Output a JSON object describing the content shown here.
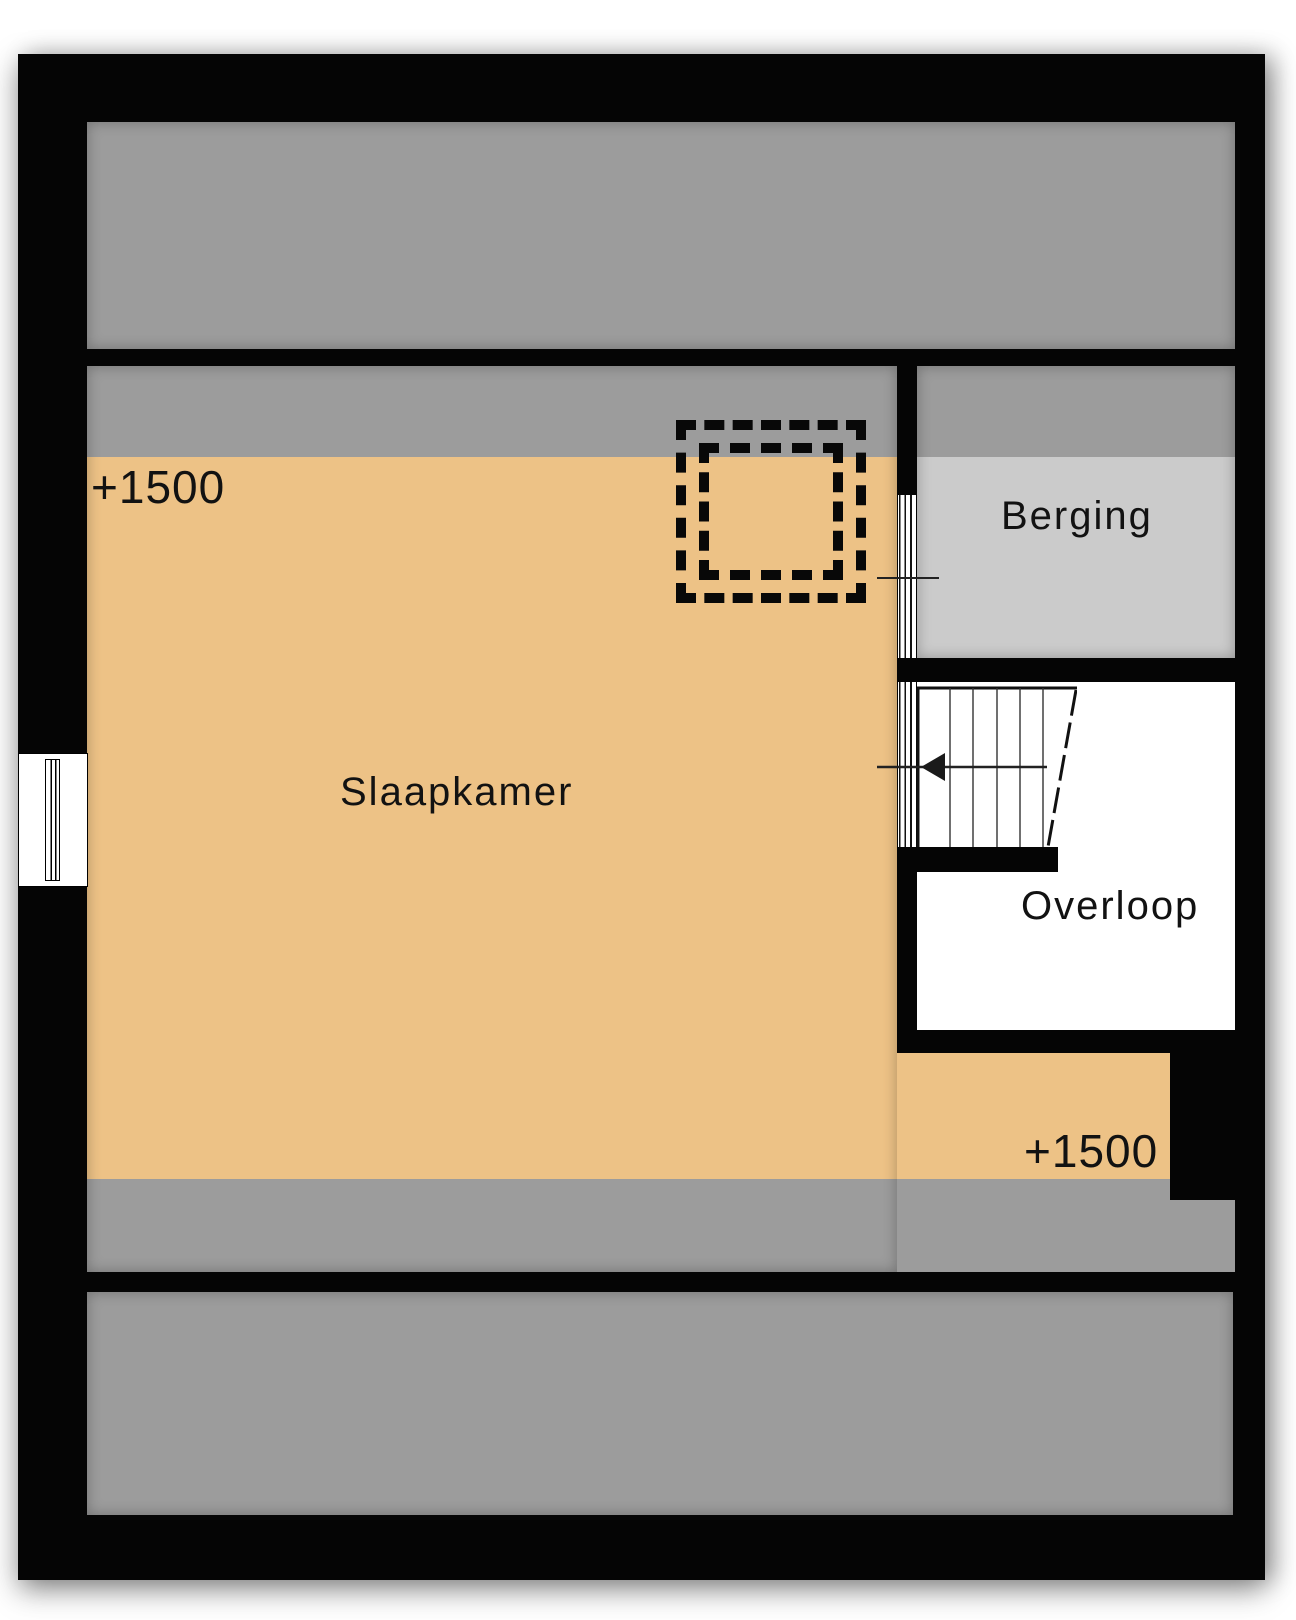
{
  "floorplan": {
    "labels": {
      "slaapkamer": "Slaapkamer",
      "berging": "Berging",
      "overloop": "Overloop"
    },
    "height_annotations": {
      "top_left": "+1500",
      "bottom_right": "+1500"
    },
    "colors": {
      "wall": "#050505",
      "bedroom_floor": "#edc286",
      "low_headroom_gray": "#9c9c9c",
      "storage_floor": "#cbcbcb",
      "landing_floor": "#ffffff"
    },
    "symbols": {
      "skylight": "double-dashed-rectangle",
      "stairs": {
        "treads": 6,
        "arrow_direction": "left"
      },
      "windows": 3
    }
  }
}
